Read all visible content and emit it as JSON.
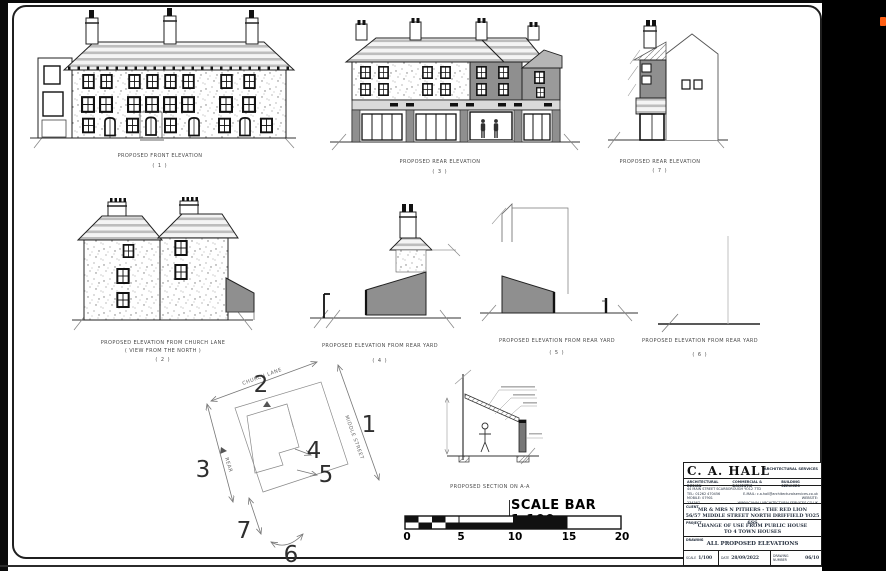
{
  "chrome": {
    "side_panel_color": "#000000",
    "marker_color": "#ff5f14",
    "sheet_border_color": "#1f1f1f",
    "gray_fill": "#8f8f8f"
  },
  "elevations": {
    "front": {
      "title": "PROPOSED FRONT ELEVATION",
      "number": "( 1 )"
    },
    "rear": {
      "title": "PROPOSED REAR ELEVATION",
      "number": "( 3 )"
    },
    "side": {
      "title": "PROPOSED REAR ELEVATION",
      "number": "( 7 )"
    },
    "church_lane": {
      "title": "PROPOSED ELEVATION FROM CHURCH LANE",
      "subtitle": "( VIEW FROM THE NORTH )",
      "number": "( 2 )"
    },
    "rear_yard_4": {
      "title": "PROPOSED ELEVATION FROM REAR YARD",
      "number": "( 4 )"
    },
    "rear_yard_5": {
      "title": "PROPOSED ELEVATION FROM REAR YARD",
      "number": "( 5 )"
    },
    "rear_yard_6": {
      "title": "PROPOSED ELEVATION FROM REAR YARD",
      "number": "( 6 )"
    }
  },
  "key_plan": {
    "streets": {
      "top": "CHURCH LANE",
      "right": "MIDDLE STREET",
      "left": "REAR"
    },
    "numbers": {
      "n1": "1",
      "n2": "2",
      "n3": "3",
      "n4": "4",
      "n5": "5",
      "n6": "6",
      "n7": "7"
    }
  },
  "section": {
    "title": "PROPOSED SECTION ON A-A"
  },
  "scale_bar": {
    "title": "SCALE BAR 1:100",
    "ticks": [
      "0",
      "5",
      "10",
      "15",
      "20"
    ]
  },
  "title_block": {
    "company": "C. A. HALL",
    "company_suffix": "ARCHITECTURAL SERVICES",
    "services": [
      "ARCHITECTURAL DESIGN",
      "COMMERCIAL & DOMESTIC",
      "BUILDING SERVICES"
    ],
    "address": "44 MAIN STREET SCARBOROUGH YO12 7TD",
    "tel": "TEL:  01262 470456",
    "mobile": "MOBILE: 07901 234567",
    "email": "E-MAIL: c.a.hall@architecturalservices.co.uk",
    "website": "WEBSITE: WWW.CAHALLARCHITECTURALSERVICES.CO.UK",
    "client_label": "CLIENT",
    "client_line1": "MR & MRS N PITHERS - THE RED LION",
    "client_line2": "56/57 MIDDLE STREET NORTH DRIFFIELD YO25 6SS",
    "project_label": "PROJECT",
    "project_line1": "CHANGE OF USE FROM PUBLIC HOUSE",
    "project_line2": "TO 4 TOWN HOUSES",
    "drawing_label": "DRAWING",
    "drawing_value": "ALL PROPOSED ELEVATIONS",
    "scale_label": "SCALE",
    "scale_value": "1/100",
    "date_label": "DATE",
    "date_value": "28/09/2022",
    "number_label": "DRAWING NUMBER",
    "number_value": "06/10"
  }
}
